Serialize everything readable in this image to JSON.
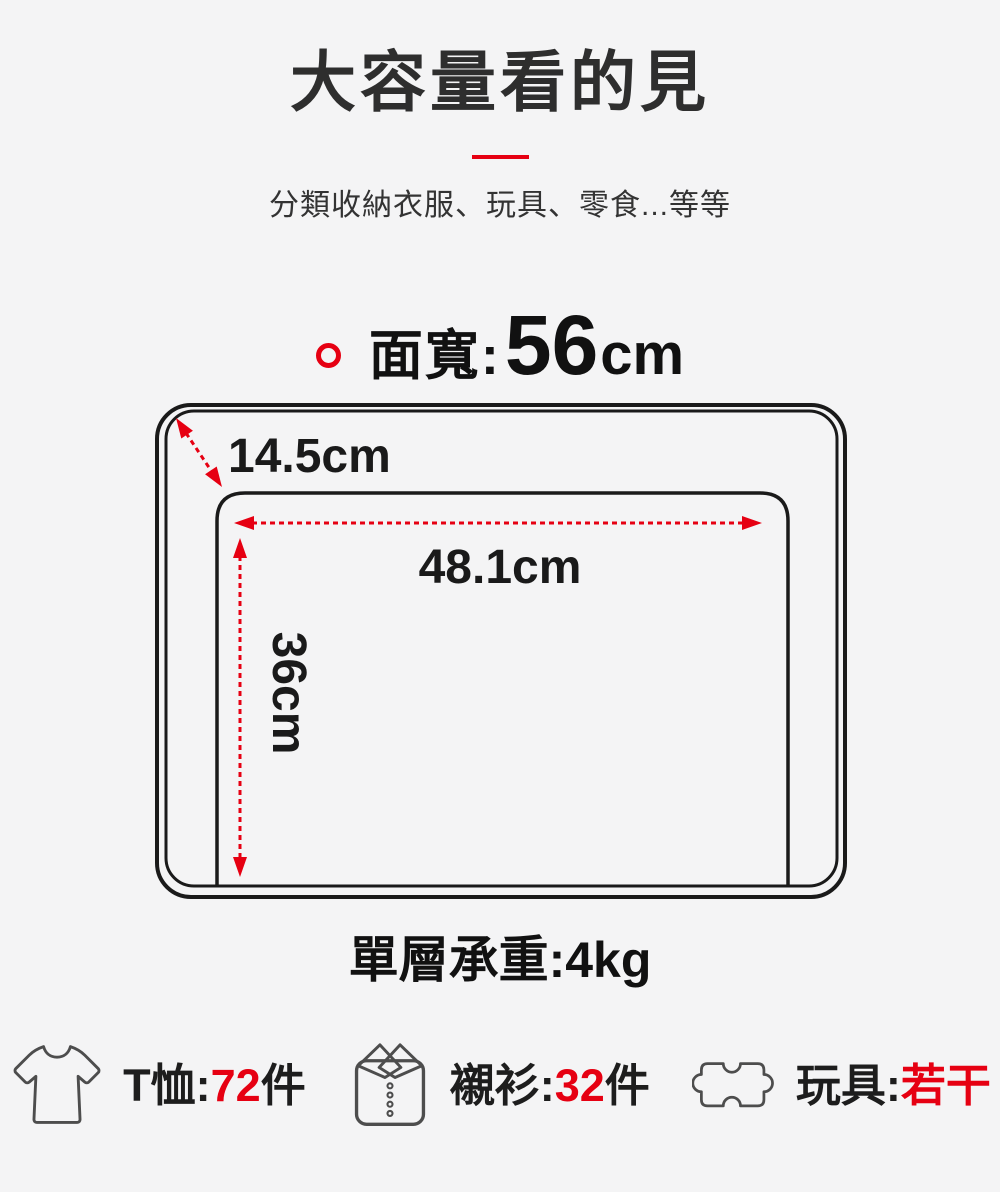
{
  "header": {
    "title": "大容量看的見",
    "subtitle": "分類收納衣服、玩具、零食...等等"
  },
  "spec": {
    "label": "面寬:",
    "value": "56",
    "unit": "cm"
  },
  "diagram": {
    "depth_label": "14.5cm",
    "width_label": "48.1cm",
    "height_label": "36cm"
  },
  "load": {
    "label": "單層承重:",
    "value": "4kg"
  },
  "capacity_items": [
    {
      "icon": "tshirt-icon",
      "label": "T恤:",
      "value": "72",
      "suffix": "件"
    },
    {
      "icon": "polo-shirt-icon",
      "label": "襯衫:",
      "value": "32",
      "suffix": "件"
    },
    {
      "icon": "puzzle-icon",
      "label": "玩具:",
      "value": "若干",
      "suffix": ""
    }
  ],
  "colors": {
    "accent_red": "#e60012",
    "text_dark": "#2f2f2f",
    "background": "#f4f4f5",
    "box_stroke": "#1a1a1a"
  }
}
